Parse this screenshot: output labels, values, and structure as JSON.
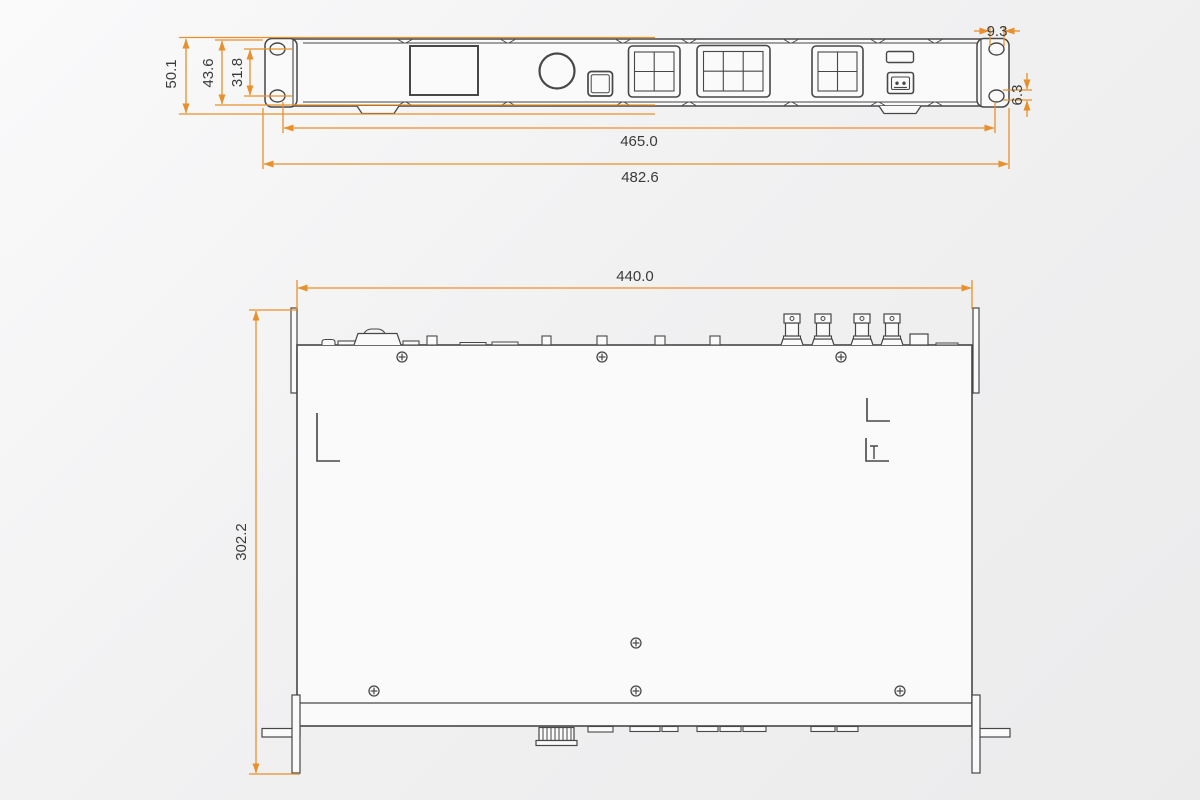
{
  "drawing": {
    "front": {
      "total_height": "50.1",
      "panel_height": "43.6",
      "hole_spacing": "31.8",
      "slot_width": "9.3",
      "slot_height": "6.3",
      "mounting_width": "465.0",
      "total_width": "482.6"
    },
    "top": {
      "width": "440.0",
      "depth": "302.2"
    },
    "colors": {
      "dimension_line": "#E8912C",
      "drawing_line": "#474747",
      "background": "#F1F1F2"
    },
    "icons": {
      "screw_head": "circle-with-cross",
      "usb_port": "usb-type-b"
    }
  }
}
